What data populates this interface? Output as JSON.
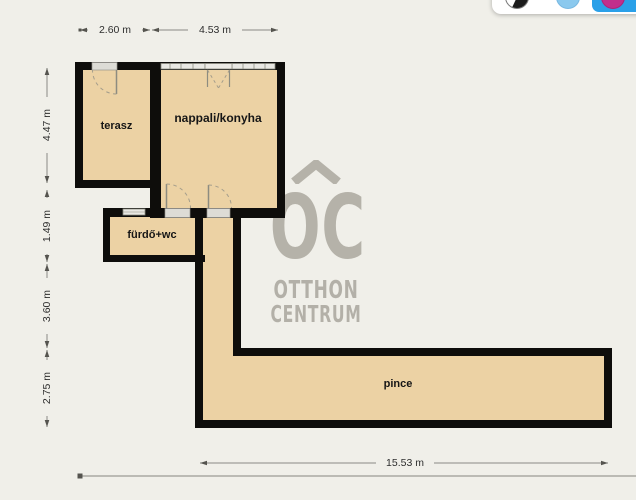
{
  "floorplan_viewer": {
    "toolbar": {
      "buttons": [
        {
          "id": "theme-bw",
          "icon": "half-black-white-circle-icon",
          "selected": false
        },
        {
          "id": "theme-blue",
          "icon": "blue-circle-icon",
          "selected": false
        },
        {
          "id": "theme-magenta",
          "icon": "magenta-circle-icon",
          "selected": true
        }
      ]
    },
    "rooms": [
      {
        "label": "terasz"
      },
      {
        "label": "nappali/konyha"
      },
      {
        "label": "fürdő+wc"
      },
      {
        "label": "pince"
      }
    ],
    "dimensions": {
      "top": [
        "2.60 m",
        "4.53 m"
      ],
      "left": [
        "4.47 m",
        "1.49 m",
        "3.60 m",
        "2.75 m"
      ],
      "bottom": [
        "15.53 m"
      ]
    },
    "watermark": {
      "logo": "OC",
      "line1": "OTTHON",
      "line2": "CENTRUM"
    },
    "colors": {
      "background": "#f0efe9",
      "room_fill": "#ecd2a4",
      "wall": "#0e0d0b",
      "watermark_gray": "#b5b2a9",
      "dimension_line": "#8a8a85",
      "toolbar_active_blue": "#2aa0e8",
      "icon_blue": "#8bc9ee",
      "icon_magenta": "#c12e8c"
    }
  }
}
